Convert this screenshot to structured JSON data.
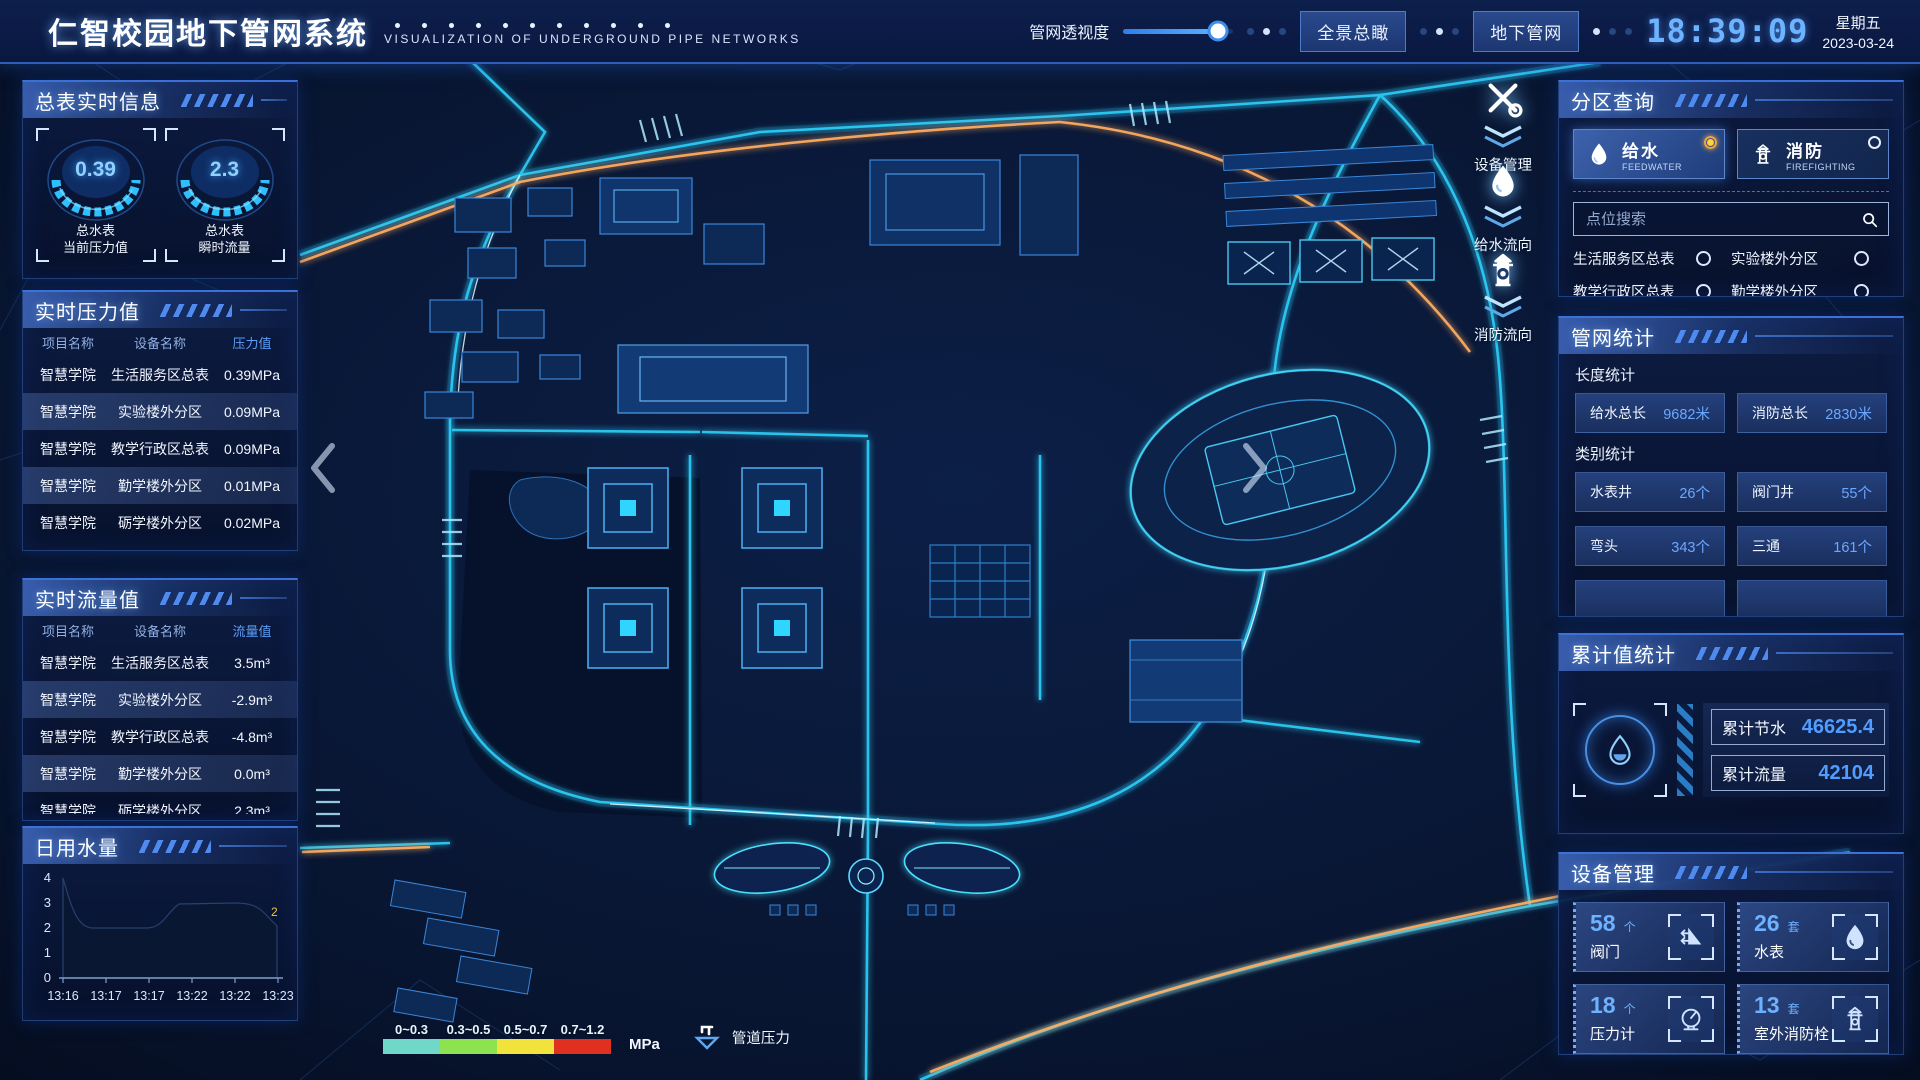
{
  "colors": {
    "accent_cyan": "#2fd5ff",
    "value_blue": "#6aa8ff",
    "clock_blue": "#6cb4ff",
    "pipe_orange": "#ffad62",
    "panel_border": "#3c72d6",
    "selected_radio_orange": "#f2a33c"
  },
  "header": {
    "title": "仁智校园地下管网系统",
    "subtitle": "VISUALIZATION OF UNDERGROUND PIPE NETWORKS",
    "transparency_label": "管网透视度",
    "view_buttons": [
      "全景总瞰",
      "地下管网"
    ],
    "clock": "18:39:09",
    "weekday": "星期五",
    "date": "2023-03-24"
  },
  "left": {
    "master": {
      "title": "总表实时信息",
      "gauges": [
        {
          "value": "0.39",
          "line1": "总水表",
          "line2": "当前压力值"
        },
        {
          "value": "2.3",
          "line1": "总水表",
          "line2": "瞬时流量"
        }
      ]
    },
    "pressure": {
      "title": "实时压力值",
      "headers": [
        "项目名称",
        "设备名称",
        "压力值"
      ],
      "rows": [
        [
          "智慧学院",
          "生活服务区总表",
          "0.39MPa"
        ],
        [
          "智慧学院",
          "实验楼外分区",
          "0.09MPa"
        ],
        [
          "智慧学院",
          "教学行政区总表",
          "0.09MPa"
        ],
        [
          "智慧学院",
          "勤学楼外分区",
          "0.01MPa"
        ],
        [
          "智慧学院",
          "砺学楼外分区",
          "0.02MPa"
        ]
      ]
    },
    "flow": {
      "title": "实时流量值",
      "headers": [
        "项目名称",
        "设备名称",
        "流量值"
      ],
      "rows": [
        [
          "智慧学院",
          "生活服务区总表",
          "3.5m³"
        ],
        [
          "智慧学院",
          "实验楼外分区",
          "-2.9m³"
        ],
        [
          "智慧学院",
          "教学行政区总表",
          "-4.8m³"
        ],
        [
          "智慧学院",
          "勤学楼外分区",
          "0.0m³"
        ],
        [
          "智慧学院",
          "砺学楼外分区",
          "2.3m³"
        ]
      ]
    },
    "daily": {
      "title": "日用水量"
    }
  },
  "chart_data": {
    "type": "area",
    "title": "日用水量",
    "x": [
      "13:16",
      "13:17",
      "13:17",
      "13:22",
      "13:22",
      "13:23"
    ],
    "values": [
      4,
      2,
      2,
      3,
      3,
      2
    ],
    "ylim": [
      0,
      4
    ],
    "yticks": [
      "4",
      "3",
      "2",
      "1",
      "0"
    ],
    "end_label": "2",
    "xlabel": "",
    "ylabel": "",
    "grid": false,
    "legend_position": "none"
  },
  "map": {
    "markers": [
      "设备管理",
      "给水流向",
      "消防流向"
    ],
    "legend": {
      "ranges": [
        {
          "label": "0~0.3",
          "color": "#6fd8c8"
        },
        {
          "label": "0.3~0.5",
          "color": "#8ce24f"
        },
        {
          "label": "0.5~0.7",
          "color": "#f2e33c"
        },
        {
          "label": "0.7~1.2",
          "color": "#e03120"
        }
      ],
      "unit": "MPa",
      "pipe_label": "管道压力"
    }
  },
  "right": {
    "zone": {
      "title": "分区查询",
      "tabs": [
        {
          "label": "给水",
          "sub": "FEEDWATER",
          "selected": true
        },
        {
          "label": "消防",
          "sub": "FIREFIGHTING",
          "selected": false
        }
      ],
      "search_placeholder": "点位搜索",
      "points": [
        "生活服务区总表",
        "实验楼外分区",
        "教学行政区总表",
        "勤学楼外分区",
        "砺学楼外分区",
        "宿舍区泵房"
      ]
    },
    "network": {
      "title": "管网统计",
      "length_label": "长度统计",
      "length_stats": [
        {
          "name": "给水总长",
          "value": "9682米"
        },
        {
          "name": "消防总长",
          "value": "2830米"
        }
      ],
      "category_label": "类别统计",
      "category_stats": [
        {
          "name": "水表井",
          "value": "26个"
        },
        {
          "name": "阀门井",
          "value": "55个"
        },
        {
          "name": "弯头",
          "value": "343个"
        },
        {
          "name": "三通",
          "value": "161个"
        }
      ]
    },
    "cumulative": {
      "title": "累计值统计",
      "items": [
        {
          "name": "累计节水",
          "value": "46625.4"
        },
        {
          "name": "累计流量",
          "value": "42104"
        }
      ]
    },
    "devices": {
      "title": "设备管理",
      "cards": [
        {
          "count": "58",
          "unit": "个",
          "name": "阀门"
        },
        {
          "count": "26",
          "unit": "套",
          "name": "水表"
        },
        {
          "count": "18",
          "unit": "个",
          "name": "压力计"
        },
        {
          "count": "13",
          "unit": "套",
          "name": "室外消防栓"
        }
      ]
    }
  }
}
